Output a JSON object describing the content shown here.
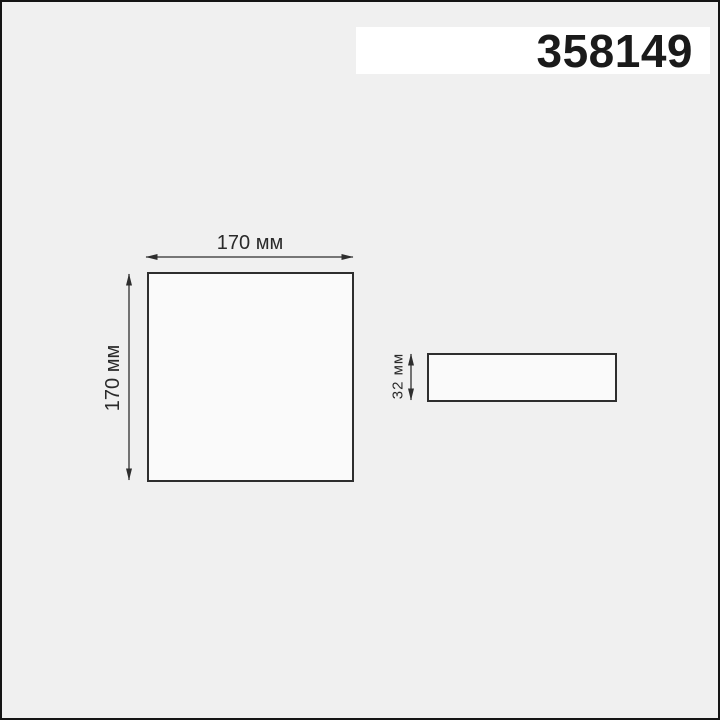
{
  "page": {
    "background_color": "#f0f0f0",
    "border_color": "#141414",
    "line_color": "#2e2e2e"
  },
  "header": {
    "part_number": "358149"
  },
  "drawing": {
    "front_view": {
      "shape": "square",
      "width_mm": 170,
      "height_mm": 170,
      "width_label": "170 мм",
      "height_label": "170 мм"
    },
    "side_view": {
      "shape": "rectangle",
      "height_mm": 32,
      "height_label": "32 мм"
    }
  }
}
